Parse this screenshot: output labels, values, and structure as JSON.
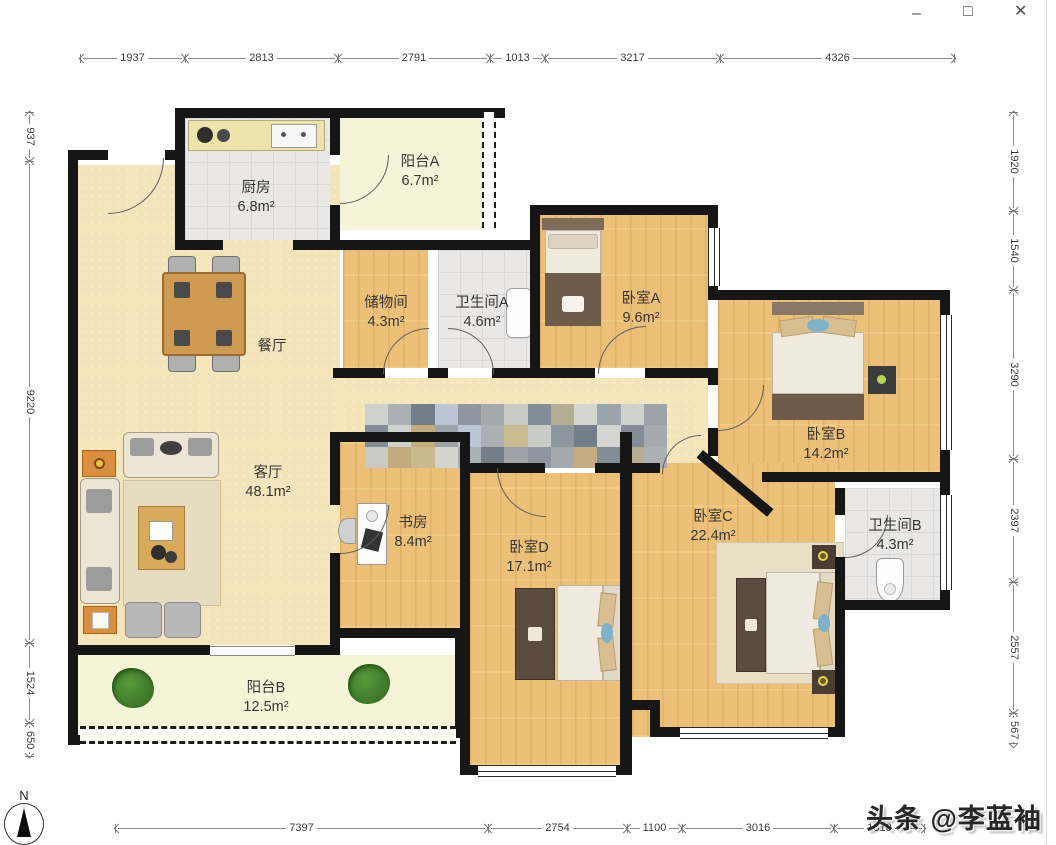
{
  "window_controls": {
    "minimize": "–",
    "maximize": "□",
    "close": "✕"
  },
  "dimensions": {
    "top": [
      "1937",
      "2813",
      "2791",
      "1013",
      "3217",
      "4326"
    ],
    "left": [
      "937",
      "9220",
      "1524",
      "650"
    ],
    "right": [
      "1920",
      "1540",
      "3290",
      "2397",
      "2557",
      "567"
    ],
    "bottom": [
      "7397",
      "2754",
      "1100",
      "3016",
      "1810"
    ]
  },
  "rooms": {
    "kitchen": {
      "name": "厨房",
      "area": "6.8m²"
    },
    "balcony_a": {
      "name": "阳台A",
      "area": "6.7m²"
    },
    "storage": {
      "name": "储物间",
      "area": "4.3m²"
    },
    "bath_a": {
      "name": "卫生间A",
      "area": "4.6m²"
    },
    "bedroom_a": {
      "name": "卧室A",
      "area": "9.6m²"
    },
    "bedroom_b": {
      "name": "卧室B",
      "area": "14.2m²"
    },
    "dining": {
      "name": "餐厅",
      "area": ""
    },
    "living": {
      "name": "客厅",
      "area": "48.1m²"
    },
    "study": {
      "name": "书房",
      "area": "8.4m²"
    },
    "bedroom_d": {
      "name": "卧室D",
      "area": "17.1m²"
    },
    "bedroom_c": {
      "name": "卧室C",
      "area": "22.4m²"
    },
    "bath_b": {
      "name": "卫生间B",
      "area": "4.3m²"
    },
    "balcony_b": {
      "name": "阳台B",
      "area": "12.5m²"
    }
  },
  "compass": {
    "north_label": "N"
  },
  "watermark": {
    "text": "头条 @李蓝袖"
  },
  "watermark_mosaic": {
    "colors": [
      "#cdd2ce",
      "#b9c4d6",
      "#c7cbc7",
      "#d3d5d1",
      "#9aa1a9",
      "#c2aa7e",
      "#a9aeb3",
      "#8a949f",
      "#7e8a96",
      "#99a2ac",
      "#c8b98e",
      "#6f7a86",
      "#a2a8ae",
      "#b4ab94"
    ]
  },
  "colors": {
    "wall": "#161616",
    "wood_floor": "#ecc078",
    "tile_floor": "#e9e8e6",
    "living_floor": "#f4e4ba",
    "balcony_floor": "#f6f4d8"
  }
}
